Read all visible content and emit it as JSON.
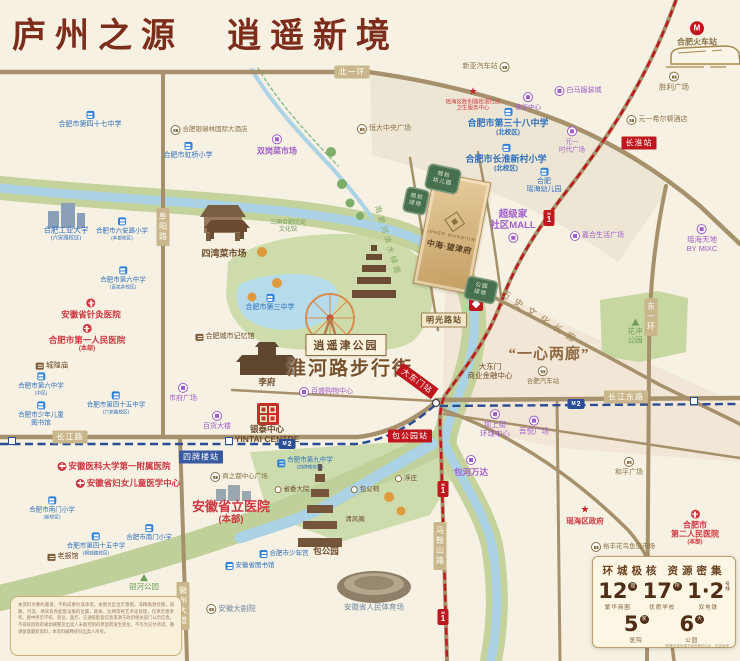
{
  "title": "庐州之源　逍遥新境",
  "colors": {
    "title": "#7c2d1c",
    "metro_line1": "#c0161d",
    "metro_line2": "#2b4d96",
    "road": "#a6916c",
    "river": "#abd3e5",
    "project_gold": "#d9b886"
  },
  "project": {
    "name_en": "INNER MANSION",
    "name_cn": "中海·望津府"
  },
  "plots": [
    {
      "lines": [
        "规划",
        "幼儿园"
      ],
      "x": 443,
      "y": 179,
      "w": 34,
      "h": 26,
      "rot": 12
    },
    {
      "lines": [
        "规划",
        "绿地"
      ],
      "x": 416,
      "y": 201,
      "w": 24,
      "h": 26,
      "rot": 12
    },
    {
      "lines": [
        "公园",
        "绿地"
      ],
      "x": 481,
      "y": 290,
      "w": 32,
      "h": 24,
      "rot": 12
    }
  ],
  "landmarks": [
    {
      "t": "淮河路步行街",
      "x": 350,
      "y": 367,
      "cls": "lbl-huaihe"
    },
    {
      "t": "“一心两廊”",
      "x": 549,
      "y": 353,
      "cls": "lbl-yixin"
    },
    {
      "t": "历史文化长廊",
      "x": 541,
      "y": 317,
      "cls": "lbl-corridor"
    },
    {
      "t": "南淝河滨水绿廊",
      "x": 388,
      "y": 241,
      "cls": "lbl-river"
    },
    {
      "t": "逍遥津公园",
      "x": 346,
      "y": 345,
      "cls": "lbl-box"
    }
  ],
  "roads": [
    {
      "t": "北一环",
      "x": 352,
      "y": 72
    },
    {
      "t": "阜阳路",
      "x": 163,
      "y": 227,
      "v": 1
    },
    {
      "t": "长江路",
      "x": 70,
      "y": 437
    },
    {
      "t": "长江东路",
      "x": 626,
      "y": 397
    },
    {
      "t": "东一环",
      "x": 651,
      "y": 317,
      "v": 1
    },
    {
      "t": "马鞍山路",
      "x": 440,
      "y": 546,
      "v": 1
    },
    {
      "t": "徽州大道",
      "x": 183,
      "y": 606,
      "v": 1
    }
  ],
  "stations": [
    {
      "t": "长淮站",
      "x": 639,
      "y": 143,
      "line": "1"
    },
    {
      "t": "明光路站",
      "x": 444,
      "y": 320,
      "line": "t"
    },
    {
      "t": "大东门站",
      "x": 417,
      "y": 381,
      "line": "1",
      "rot": 36
    },
    {
      "t": "包公园站",
      "x": 410,
      "y": 436,
      "line": "1"
    },
    {
      "t": "四牌楼站",
      "x": 201,
      "y": 457,
      "line": "2"
    }
  ],
  "metro_badges": [
    {
      "line": "1",
      "x": 549,
      "y": 218
    },
    {
      "line": "1",
      "x": 443,
      "y": 489
    },
    {
      "line": "1",
      "x": 443,
      "y": 617
    },
    {
      "line": "2",
      "x": 287,
      "y": 444
    },
    {
      "line": "2",
      "x": 576,
      "y": 404
    }
  ],
  "line2_markers": [
    {
      "x": 12,
      "y": 441
    },
    {
      "x": 229,
      "y": 441
    },
    {
      "x": 694,
      "y": 401
    }
  ],
  "icon_glyphs": {
    "star": "★",
    "rail": "M"
  },
  "pois": [
    {
      "l": [
        "合肥火车站"
      ],
      "x": 697,
      "y": 34,
      "cls": "tan",
      "b": 1,
      "fs": 8,
      "icon": "rail",
      "ip": "t"
    },
    {
      "l": [
        "新亚汽车站"
      ],
      "x": 486,
      "y": 67,
      "cls": "tan",
      "fs": 7,
      "icon": "plaza",
      "ip": "r"
    },
    {
      "l": [
        "胜利广场"
      ],
      "x": 674,
      "y": 82,
      "cls": "tan",
      "fs": 7.5,
      "icon": "plaza",
      "ip": "t"
    },
    {
      "l": [
        "白马服装城"
      ],
      "x": 578,
      "y": 91,
      "cls": "purple",
      "fs": 7,
      "icon": "mall",
      "ip": "l"
    },
    {
      "l": [
        "瑶海区胜利路街道社区",
        "卫生服务中心"
      ],
      "x": 473,
      "y": 100,
      "cls": "red",
      "fs": 5.5,
      "icon": "star",
      "ip": "t"
    },
    {
      "l": [
        "意华中心"
      ],
      "x": 528,
      "y": 102,
      "cls": "purple",
      "fs": 6.5,
      "icon": "mall",
      "ip": "t"
    },
    {
      "l": [
        "元一希尔顿酒店"
      ],
      "x": 657,
      "y": 120,
      "cls": "tan",
      "fs": 7,
      "icon": "plaza",
      "ip": "l"
    },
    {
      "l": [
        "合肥市第三十八中学",
        "(北校区)"
      ],
      "x": 508,
      "y": 122,
      "cls": "blue",
      "fs": 9,
      "b": 1,
      "icon": "school",
      "ip": "t"
    },
    {
      "l": [
        "元一",
        "时代广场"
      ],
      "x": 572,
      "y": 140,
      "cls": "purple",
      "fs": 6.5,
      "icon": "mall",
      "ip": "t"
    },
    {
      "l": [
        "合肥市长淮新村小学",
        "(北校区)"
      ],
      "x": 506,
      "y": 158,
      "cls": "blue",
      "fs": 9,
      "b": 1,
      "icon": "school",
      "ip": "t"
    },
    {
      "l": [
        "合肥",
        "瑶海幼儿园"
      ],
      "x": 544,
      "y": 181,
      "cls": "blue",
      "fs": 7,
      "icon": "school",
      "ip": "t"
    },
    {
      "l": [
        "恒大中央广场"
      ],
      "x": 384,
      "y": 129,
      "cls": "tan",
      "fs": 7,
      "icon": "plaza",
      "ip": "l"
    },
    {
      "l": [
        "合肥银瑞林国际大酒店"
      ],
      "x": 209,
      "y": 130,
      "cls": "tan",
      "fs": 6.5,
      "icon": "plaza",
      "ip": "l"
    },
    {
      "l": [
        "双岗菜市场"
      ],
      "x": 277,
      "y": 145,
      "cls": "purple",
      "fs": 8,
      "b": 1,
      "icon": "mall",
      "ip": "t"
    },
    {
      "l": [
        "合肥市第四十七中学"
      ],
      "x": 90,
      "y": 120,
      "cls": "blue",
      "fs": 7,
      "icon": "school",
      "ip": "t"
    },
    {
      "l": [
        "合肥市虹桥小学"
      ],
      "x": 188,
      "y": 151,
      "cls": "blue",
      "fs": 7,
      "icon": "school",
      "ip": "t"
    },
    {
      "l": [
        "超级家",
        "社区MALL"
      ],
      "x": 513,
      "y": 226,
      "cls": "purple",
      "fs": 9.5,
      "b": 1,
      "icon": "mall",
      "ip": "b"
    },
    {
      "l": [
        "嘉合生活广场"
      ],
      "x": 597,
      "y": 236,
      "cls": "purple",
      "fs": 7,
      "icon": "mall",
      "ip": "l"
    },
    {
      "l": [
        "瑶海天地",
        "BY MIXC"
      ],
      "x": 702,
      "y": 239,
      "cls": "purple",
      "fs": 7.5,
      "icon": "mall",
      "ip": "t"
    },
    {
      "l": [
        "合肥工业大学",
        "(六安路校区)"
      ],
      "x": 66,
      "y": 234,
      "cls": "blue",
      "fs": 7.5,
      "ip": "t"
    },
    {
      "l": [
        "合肥市六安路小学",
        "(本部校区)"
      ],
      "x": 122,
      "y": 229,
      "cls": "blue",
      "fs": 6.5,
      "icon": "school",
      "ip": "t"
    },
    {
      "l": [
        "四湾菜市场"
      ],
      "x": 224,
      "y": 254,
      "cls": "brown",
      "fs": 9,
      "b": 1
    },
    {
      "l": [
        "三国合肥历史",
        "文化馆"
      ],
      "x": 288,
      "y": 227,
      "cls": "green",
      "fs": 6
    },
    {
      "l": [
        "合肥市第三中学"
      ],
      "x": 270,
      "y": 303,
      "cls": "blue",
      "fs": 7,
      "icon": "school",
      "ip": "t"
    },
    {
      "l": [
        "合肥城市记忆馆"
      ],
      "x": 225,
      "y": 337,
      "cls": "brown",
      "fs": 7,
      "icon": "temple",
      "ip": "l"
    },
    {
      "l": [
        "城隍庙"
      ],
      "x": 52,
      "y": 366,
      "cls": "brown",
      "fs": 7.5,
      "icon": "temple",
      "ip": "l"
    },
    {
      "l": [
        "安徽省针灸医院"
      ],
      "x": 91,
      "y": 309,
      "cls": "red",
      "fs": 8.5,
      "b": 1,
      "icon": "hosp",
      "ip": "t"
    },
    {
      "l": [
        "合肥市第一人民医院",
        "(本部)"
      ],
      "x": 87,
      "y": 338,
      "cls": "red",
      "fs": 8.5,
      "b": 1,
      "icon": "hosp",
      "ip": "t"
    },
    {
      "l": [
        "合肥市第六中学",
        "(百花井校区)"
      ],
      "x": 123,
      "y": 278,
      "cls": "blue",
      "fs": 6.5,
      "icon": "school",
      "ip": "t"
    },
    {
      "l": [
        "合肥市第六中学",
        "(中区)"
      ],
      "x": 41,
      "y": 384,
      "cls": "blue",
      "fs": 6.5,
      "icon": "school",
      "ip": "t"
    },
    {
      "l": [
        "合肥市少年儿童",
        "图书馆"
      ],
      "x": 41,
      "y": 414,
      "cls": "blue",
      "fs": 6.5,
      "icon": "school",
      "ip": "t"
    },
    {
      "l": [
        "合肥市第四十五中学",
        "(六安路校区)"
      ],
      "x": 116,
      "y": 403,
      "cls": "blue",
      "fs": 6.5,
      "icon": "school",
      "ip": "t"
    },
    {
      "l": [
        "市府广场"
      ],
      "x": 183,
      "y": 393,
      "cls": "purple",
      "fs": 7,
      "icon": "mall",
      "ip": "t"
    },
    {
      "l": [
        "百货大楼"
      ],
      "x": 217,
      "y": 421,
      "cls": "purple",
      "fs": 7,
      "icon": "mall",
      "ip": "t"
    },
    {
      "l": [
        "银泰中心",
        "YINTAI CENTRE"
      ],
      "x": 267,
      "y": 434,
      "cls": "brown",
      "fs": 8.5,
      "b": 1
    },
    {
      "l": [
        "百盛购物中心"
      ],
      "x": 326,
      "y": 392,
      "cls": "purple",
      "fs": 7,
      "icon": "mall",
      "ip": "l"
    },
    {
      "l": [
        "李府"
      ],
      "x": 267,
      "y": 382,
      "cls": "brown",
      "fs": 8.5,
      "b": 1
    },
    {
      "l": [
        "安徽医科大学第一附属医院"
      ],
      "x": 114,
      "y": 466,
      "cls": "red",
      "fs": 8.5,
      "b": 1,
      "icon": "hosp",
      "ip": "l"
    },
    {
      "l": [
        "安徽省妇女儿童医学中心"
      ],
      "x": 128,
      "y": 483,
      "cls": "red",
      "fs": 8.5,
      "b": 1,
      "icon": "hosp",
      "ip": "l"
    },
    {
      "l": [
        "合肥市南门小学",
        "(新校区)"
      ],
      "x": 52,
      "y": 508,
      "cls": "blue",
      "fs": 6.5,
      "icon": "school",
      "ip": "t"
    },
    {
      "l": [
        "合肥市南门小学"
      ],
      "x": 149,
      "y": 533,
      "cls": "blue",
      "fs": 6.5,
      "icon": "school",
      "ip": "t"
    },
    {
      "l": [
        "合肥市第四十五中学",
        "(桐城路校区)"
      ],
      "x": 96,
      "y": 544,
      "cls": "blue",
      "fs": 6.5,
      "icon": "school",
      "ip": "t"
    },
    {
      "l": [
        "老报馆"
      ],
      "x": 63,
      "y": 557,
      "cls": "brown",
      "fs": 7,
      "icon": "temple",
      "ip": "l"
    },
    {
      "l": [
        "银河公园"
      ],
      "x": 144,
      "y": 583,
      "cls": "green",
      "fs": 7.5,
      "icon": "tree",
      "ip": "t"
    },
    {
      "l": [
        "商之都中心广场"
      ],
      "x": 239,
      "y": 477,
      "cls": "tan",
      "fs": 6.5,
      "icon": "plaza",
      "ip": "l"
    },
    {
      "l": [
        "安徽省立医院",
        "(本部)"
      ],
      "x": 231,
      "y": 512,
      "cls": "red",
      "fs": 13,
      "b": 1
    },
    {
      "l": [
        "合肥市第九中学",
        "(四牌楼校区)"
      ],
      "x": 305,
      "y": 463,
      "cls": "blue",
      "fs": 6.5,
      "icon": "school",
      "ip": "l"
    },
    {
      "l": [
        "省委大院"
      ],
      "x": 292,
      "y": 490,
      "cls": "brown",
      "fs": 6.5,
      "icon": "dot",
      "ip": "l"
    },
    {
      "l": [
        "合肥市少年宫"
      ],
      "x": 284,
      "y": 554,
      "cls": "blue",
      "fs": 6.5,
      "icon": "school",
      "ip": "l"
    },
    {
      "l": [
        "安徽省图书馆"
      ],
      "x": 250,
      "y": 566,
      "cls": "blue",
      "fs": 6.5,
      "icon": "school",
      "ip": "l"
    },
    {
      "l": [
        "安徽大剧院"
      ],
      "x": 231,
      "y": 609,
      "cls": "slate",
      "fs": 7.5,
      "icon": "plaza",
      "ip": "l"
    },
    {
      "l": [
        "包公园"
      ],
      "x": 326,
      "y": 551,
      "cls": "brown",
      "fs": 8.5,
      "b": 1
    },
    {
      "l": [
        "清风阁"
      ],
      "x": 355,
      "y": 520,
      "cls": "brown",
      "fs": 6.5
    },
    {
      "l": [
        "包公祠"
      ],
      "x": 365,
      "y": 490,
      "cls": "brown",
      "fs": 6.5,
      "icon": "dot",
      "ip": "l"
    },
    {
      "l": [
        "浮庄"
      ],
      "x": 406,
      "y": 479,
      "cls": "brown",
      "fs": 6.5,
      "icon": "dot",
      "ip": "l"
    },
    {
      "l": [
        "安徽省人民体育场"
      ],
      "x": 374,
      "y": 608,
      "cls": "slate",
      "fs": 7.5
    },
    {
      "l": [
        "包河万达"
      ],
      "x": 471,
      "y": 466,
      "cls": "purple",
      "fs": 8.5,
      "b": 1,
      "icon": "mall",
      "ip": "t"
    },
    {
      "l": [
        "大东门",
        "商业金融中心"
      ],
      "x": 490,
      "y": 372,
      "cls": "brown",
      "fs": 7.5
    },
    {
      "l": [
        "合肥汽车站"
      ],
      "x": 543,
      "y": 376,
      "cls": "tan",
      "fs": 6.5,
      "icon": "plaza",
      "ip": "t"
    },
    {
      "l": [
        "坝上街",
        "环球中心"
      ],
      "x": 495,
      "y": 424,
      "cls": "purple",
      "fs": 7.5,
      "icon": "mall",
      "ip": "t"
    },
    {
      "l": [
        "吾悦广场"
      ],
      "x": 534,
      "y": 426,
      "cls": "purple",
      "fs": 7.5,
      "icon": "mall",
      "ip": "t"
    },
    {
      "l": [
        "花冲",
        "公园"
      ],
      "x": 635,
      "y": 332,
      "cls": "green",
      "fs": 7.5,
      "icon": "tree",
      "ip": "t"
    },
    {
      "l": [
        "和平广场"
      ],
      "x": 629,
      "y": 467,
      "cls": "tan",
      "fs": 7,
      "icon": "plaza",
      "ip": "t"
    },
    {
      "l": [
        "瑶海区政府"
      ],
      "x": 585,
      "y": 516,
      "cls": "red",
      "fs": 7.5,
      "b": 1,
      "icon": "star",
      "ip": "t"
    },
    {
      "l": [
        "合肥市",
        "第二人民医院",
        "(本部)"
      ],
      "x": 695,
      "y": 528,
      "cls": "red",
      "fs": 8,
      "b": 1,
      "icon": "hosp",
      "ip": "t"
    },
    {
      "l": [
        "裕丰花鸟鱼虫市场"
      ],
      "x": 623,
      "y": 547,
      "cls": "tan",
      "fs": 6.5,
      "icon": "plaza",
      "ip": "l"
    }
  ],
  "stats": {
    "title": "环城极核  资源密集",
    "items": [
      {
        "num": "12",
        "unit": "座",
        "label": "繁华商圈"
      },
      {
        "num": "17",
        "unit": "所",
        "label": "优质学校"
      },
      {
        "num": "1·2",
        "unit": "号线",
        "label": "双地铁",
        "dual": true
      },
      {
        "num": "5",
        "unit": "家",
        "label": "医院"
      },
      {
        "num": "6",
        "unit": "大",
        "label": "公园"
      }
    ],
    "footnote": "*配套信息来源于政府规划公示，仅供参考"
  },
  "disclaimer": "本资料为要约邀请，不构成要约或承诺。本图为区位示意图，非精确测绘图，道路、河流、地块及各配套设施的位置、距离、比例等经艺术化处理，仅供示意参考。图中所示学校、商业、医疗、交通等配套信息来源于政府相关部门公示信息，不排除因政府规划调整及出卖人未能控制的原因而发生变化，不作为交付承诺。敬请留意最新资料，本资料解释权归出卖人所有。"
}
